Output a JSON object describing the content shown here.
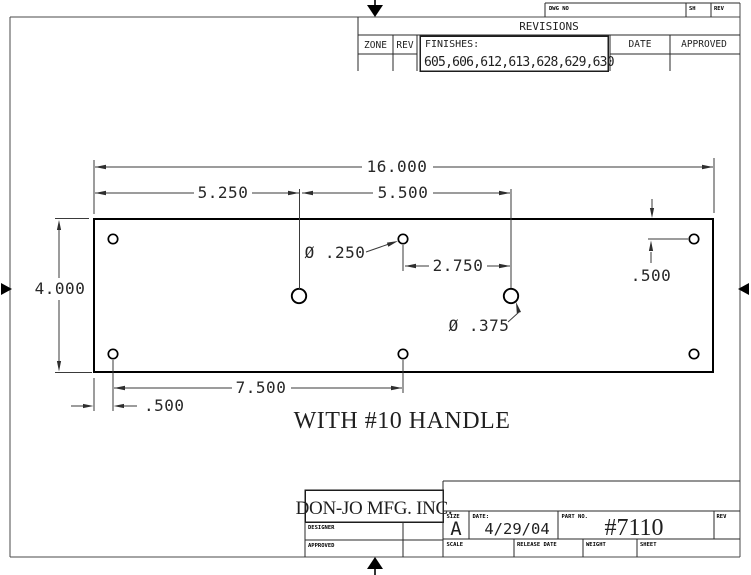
{
  "sheet_header": {
    "dwg_no_label": "DWG NO",
    "sh_label": "SH",
    "rev_label": "REV"
  },
  "revisions_table": {
    "title": "REVISIONS",
    "zone_label": "ZONE",
    "rev_label": "REV",
    "finishes_label": "FINISHES:",
    "finishes_values": "605,606,612,613,628,629,630",
    "date_label": "DATE",
    "approved_label": "APPROVED"
  },
  "drawing": {
    "note": "WITH #10 HANDLE",
    "dimensions": {
      "overall_width": "16.000",
      "plate_height": "4.000",
      "left_edge_to_pull_hole": "5.250",
      "pull_hole_spacing": "5.500",
      "small_hole_diameter": "Ø .250",
      "pull_to_top_hole": "2.750",
      "large_hole_diameter": "Ø .375",
      "top_hole_inset": ".500",
      "bottom_hole_spacing": "7.500",
      "bottom_hole_inset": ".500"
    }
  },
  "title_block": {
    "company": "DON-JO MFG. INC.",
    "designer_label": "DESIGNER",
    "approved_label": "APPROVED",
    "size_label": "SIZE",
    "size_value": "A",
    "date_label": "DATE:",
    "date_value": "4/29/04",
    "part_no_label": "PART NO.",
    "part_no_value": "#7110",
    "rev_label": "REV",
    "scale_label": "SCALE",
    "release_date_label": "RELEASE DATE",
    "weight_label": "WEIGHT",
    "sheet_label": "SHEET"
  }
}
